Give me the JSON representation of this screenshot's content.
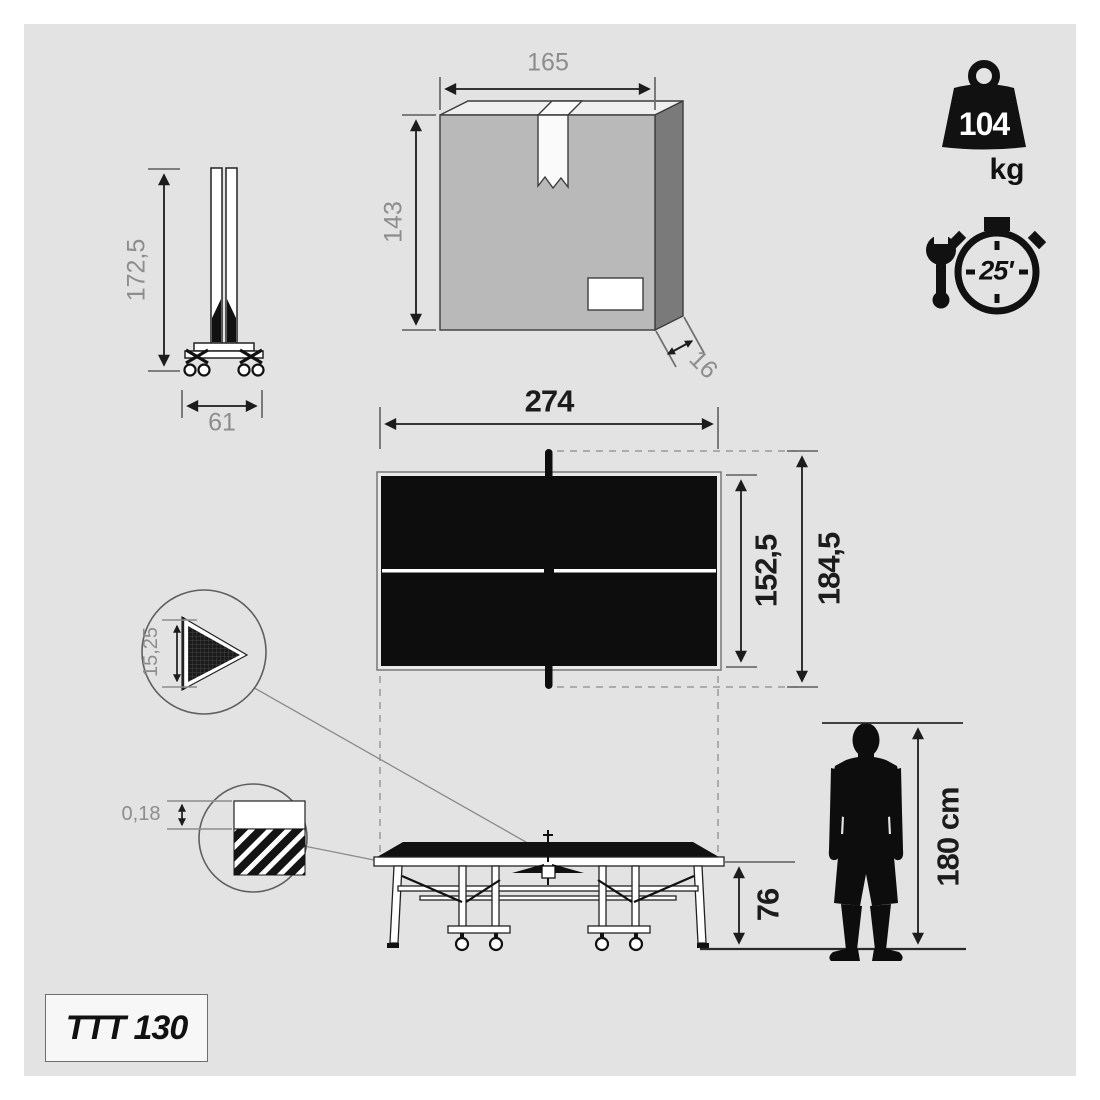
{
  "colors": {
    "canvas": "#e3e3e3",
    "ink": "#1c1c1c",
    "dim_gray": "#8d8d8d",
    "box_front": "#b9b9b9",
    "box_side": "#7a7a7a",
    "box_top": "#efefef"
  },
  "model": {
    "label": "TTT 130"
  },
  "folded_table": {
    "height": "172,5",
    "width": "61"
  },
  "package": {
    "width": "165",
    "height": "143",
    "depth": "16"
  },
  "weight": {
    "value": "104",
    "unit": "kg"
  },
  "assembly_time": {
    "value": "25'"
  },
  "top_view": {
    "length": "274",
    "table_width": "152,5",
    "net_width": "184,5"
  },
  "net_detail": {
    "net_height": "15,25"
  },
  "surface_detail": {
    "thickness": "0,18"
  },
  "side_view": {
    "table_height": "76"
  },
  "person": {
    "height": "180 cm"
  }
}
